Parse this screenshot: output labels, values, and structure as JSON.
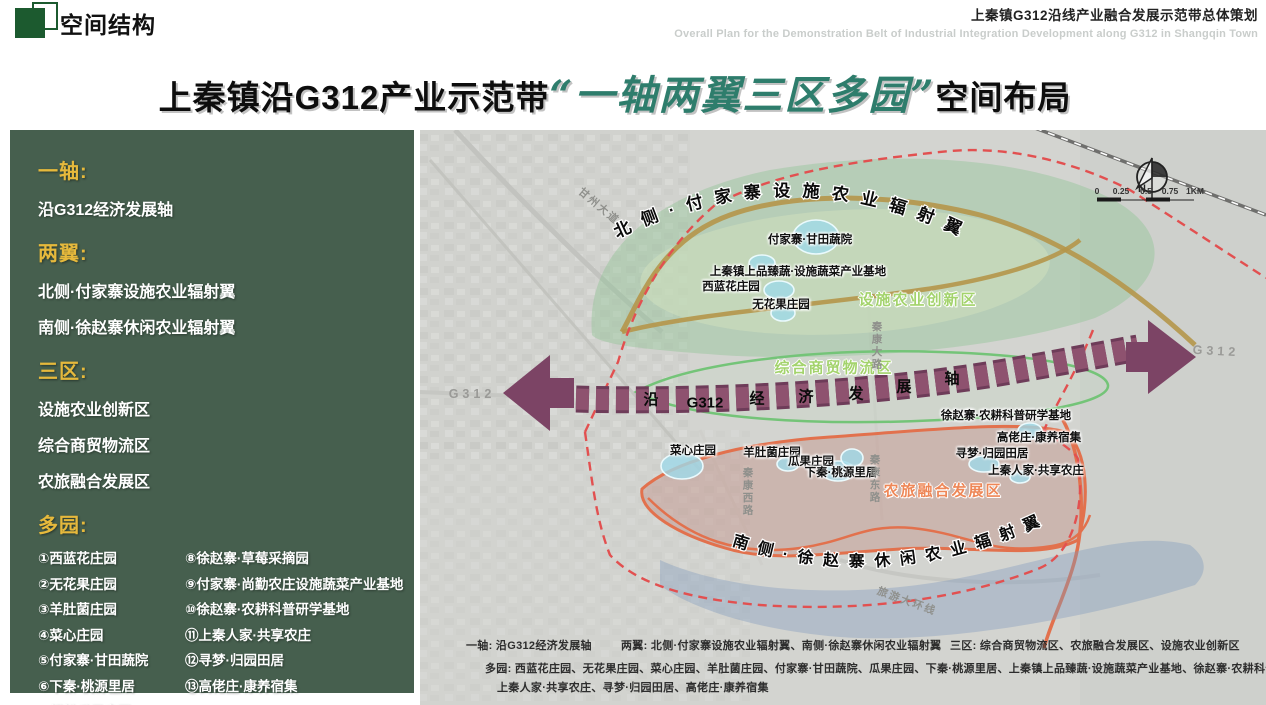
{
  "header": {
    "title": "空间结构",
    "right_title": "上秦镇G312沿线产业融合发展示范带总体策划",
    "right_subtitle": "Overall Plan for the Demonstration Belt of Industrial Integration Development along G312 in Shangqin Town"
  },
  "main_title": {
    "part1": "上秦镇沿G312产业示范带",
    "highlight": "“一轴两翼三区多园”",
    "part2": "空间布局"
  },
  "colors": {
    "sidebar_bg": "#465f4e",
    "sidebar_heading": "#e6b93c",
    "title_green": "#2e7d6c",
    "logo_green": "#1c5a2f",
    "axis_purple": "#7c4465",
    "boundary_red": "#e25050",
    "north_zone_green": "#8fc493",
    "south_road_orange": "#e2714d",
    "zone_label_green": "#a3d36c",
    "zone_label_orange": "#ee8757",
    "pond_cyan": "#9fd9e8"
  },
  "sidebar": {
    "sections": [
      {
        "title": "一轴:",
        "items": [
          "沿G312经济发展轴"
        ]
      },
      {
        "title": "两翼:",
        "items": [
          "北侧·付家寨设施农业辐射翼",
          "南侧·徐赵寨休闲农业辐射翼"
        ]
      },
      {
        "title": "三区:",
        "items": [
          "设施农业创新区",
          "综合商贸物流区",
          "农旅融合发展区"
        ]
      },
      {
        "title": "多园:",
        "columns": {
          "left": [
            "①西蓝花庄园",
            "②无花果庄园",
            "③羊肚菌庄园",
            "④菜心庄园",
            "⑤付家寨·甘田蔬院",
            "⑥下秦·桃源里居",
            "⑦绿松瓜果庄园"
          ],
          "right": [
            "⑧徐赵寨·草莓采摘园",
            "⑨付家寨·尚勤农庄设施蔬菜产业基地",
            "⑩徐赵寨·农耕科普研学基地",
            "⑪上秦人家·共享农庄",
            "⑫寻梦·归园田居",
            "⑬高佬庄·康养宿集"
          ]
        }
      }
    ]
  },
  "map": {
    "north_arc": "北侧·付家寨设施农业辐射翼",
    "south_arc": "南侧·徐赵寨休闲农业辐射翼",
    "compass_n": "N",
    "labels": [
      {
        "t": "沿",
        "x": 651,
        "y": 399,
        "cls": "axis",
        "name": "axis-char"
      },
      {
        "t": "G312",
        "x": 705,
        "y": 403,
        "cls": "axis",
        "name": "axis-char"
      },
      {
        "t": "经",
        "x": 757,
        "y": 398,
        "cls": "axis",
        "name": "axis-char"
      },
      {
        "t": "济",
        "x": 806,
        "y": 396,
        "cls": "axis",
        "name": "axis-char"
      },
      {
        "t": "发",
        "x": 856,
        "y": 393,
        "cls": "axis",
        "name": "axis-char"
      },
      {
        "t": "展",
        "x": 904,
        "y": 386,
        "cls": "axis",
        "name": "axis-char"
      },
      {
        "t": "轴",
        "x": 952,
        "y": 378,
        "cls": "axis",
        "name": "axis-char"
      },
      {
        "t": "付家寨·甘田蔬院",
        "x": 810,
        "y": 239,
        "cls": "place",
        "name": "map-label"
      },
      {
        "t": "上秦镇上品臻蔬·设施蔬菜产业基地",
        "x": 798,
        "y": 271,
        "cls": "place",
        "name": "map-label"
      },
      {
        "t": "西蓝花庄园",
        "x": 731,
        "y": 286,
        "cls": "place",
        "name": "map-label"
      },
      {
        "t": "无花果庄园",
        "x": 781,
        "y": 304,
        "cls": "place",
        "name": "map-label"
      },
      {
        "t": "菜心庄园",
        "x": 693,
        "y": 450,
        "cls": "place",
        "name": "map-label"
      },
      {
        "t": "羊肚菌庄园",
        "x": 772,
        "y": 452,
        "cls": "place",
        "name": "map-label"
      },
      {
        "t": "瓜果庄园",
        "x": 811,
        "y": 461,
        "cls": "place",
        "name": "map-label"
      },
      {
        "t": "下秦·桃源里居",
        "x": 841,
        "y": 472,
        "cls": "place",
        "name": "map-label"
      },
      {
        "t": "徐赵寨·农耕科普研学基地",
        "x": 1006,
        "y": 415,
        "cls": "place",
        "name": "map-label"
      },
      {
        "t": "高佬庄·康养宿集",
        "x": 1039,
        "y": 437,
        "cls": "place",
        "name": "map-label"
      },
      {
        "t": "寻梦·归园田居",
        "x": 992,
        "y": 453,
        "cls": "place",
        "name": "map-label"
      },
      {
        "t": "上秦人家·共享农庄",
        "x": 1036,
        "y": 470,
        "cls": "place",
        "name": "map-label"
      },
      {
        "t": "设施农业创新区",
        "x": 918,
        "y": 299,
        "cls": "zone-green",
        "name": "zone-label"
      },
      {
        "t": "综合商贸物流区",
        "x": 834,
        "y": 367,
        "cls": "zone-green",
        "name": "zone-label"
      },
      {
        "t": "农旅融合发展区",
        "x": 943,
        "y": 490,
        "cls": "zone-orange",
        "name": "zone-label"
      },
      {
        "t": "甘州大道",
        "x": 599,
        "y": 206,
        "cls": "road",
        "rot": 40,
        "name": "road-label"
      },
      {
        "t": "秦康大路",
        "x": 877,
        "y": 346,
        "cls": "road-v",
        "name": "road-label"
      },
      {
        "t": "秦康西路",
        "x": 748,
        "y": 492,
        "cls": "road-v",
        "name": "road-label"
      },
      {
        "t": "秦康东路",
        "x": 875,
        "y": 479,
        "cls": "road-v",
        "name": "road-label"
      },
      {
        "t": "旅游大环线",
        "x": 907,
        "y": 601,
        "cls": "road",
        "rot": 20,
        "name": "road-label"
      },
      {
        "t": "G312",
        "x": 472,
        "y": 394,
        "cls": "hwy",
        "name": "highway-label"
      },
      {
        "t": "G312",
        "x": 1216,
        "y": 351,
        "cls": "hwy",
        "rot": 3,
        "name": "highway-label"
      },
      {
        "t": "一轴: 沿G312经济发展轴",
        "x": 466,
        "y": 645,
        "cls": "legend",
        "name": "legend-row"
      },
      {
        "t": "两翼: 北侧·付家寨设施农业辐射翼、南侧·徐赵寨休闲农业辐射翼",
        "x": 621,
        "y": 645,
        "cls": "legend",
        "name": "legend-row"
      },
      {
        "t": "三区: 综合商贸物流区、农旅融合发展区、设施农业创新区",
        "x": 950,
        "y": 645,
        "cls": "legend",
        "name": "legend-row"
      },
      {
        "t": "多园: 西蓝花庄园、无花果庄园、菜心庄园、羊肚菌庄园、付家寨·甘田蔬院、瓜果庄园、下秦·桃源里居、上秦镇上品臻蔬·设施蔬菜产业基地、徐赵寨·农耕科普研学基地",
        "x": 485,
        "y": 668,
        "cls": "legend",
        "name": "legend-row"
      },
      {
        "t": "上秦人家·共享农庄、寻梦·归园田居、高佬庄·康养宿集",
        "x": 497,
        "y": 687,
        "cls": "legend",
        "name": "legend-row"
      },
      {
        "t": "N",
        "x": 1142,
        "y": 189,
        "cls": "compass-n",
        "name": "compass-n-label"
      },
      {
        "t": "0",
        "x": 1097,
        "y": 191,
        "cls": "tick",
        "name": "scale-tick"
      },
      {
        "t": "0.25",
        "x": 1121,
        "y": 191,
        "cls": "tick",
        "name": "scale-tick"
      },
      {
        "t": "0.5",
        "x": 1146,
        "y": 191,
        "cls": "tick",
        "name": "scale-tick"
      },
      {
        "t": "0.75",
        "x": 1170,
        "y": 191,
        "cls": "tick",
        "name": "scale-tick"
      },
      {
        "t": "1KM",
        "x": 1195,
        "y": 191,
        "cls": "tick",
        "name": "scale-tick"
      }
    ]
  }
}
